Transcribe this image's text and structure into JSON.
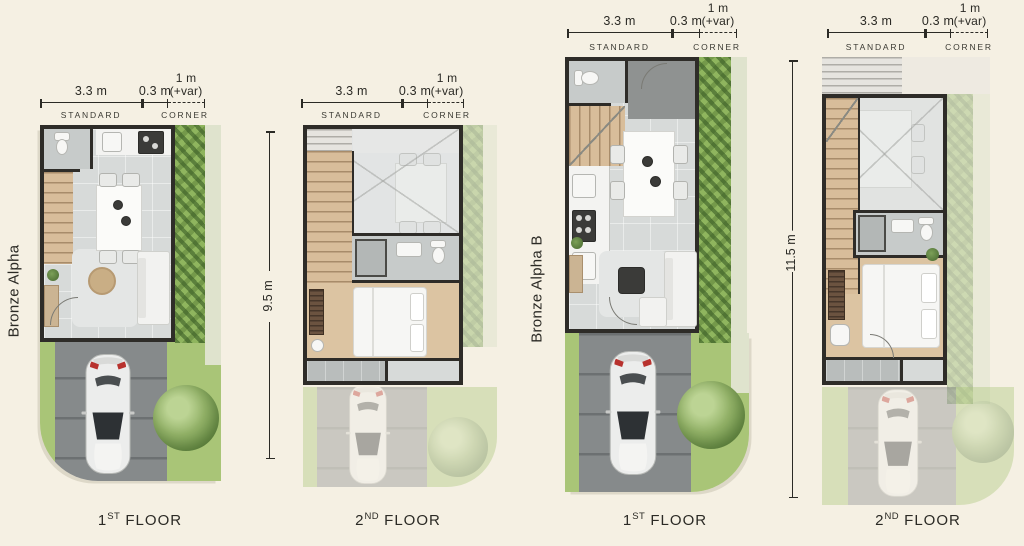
{
  "palette": {
    "bg": "#f5f0e3",
    "ink": "#2b2a25",
    "wall": "#2e2c28",
    "floor": "#d7dad9",
    "floorDark": "#c7cbca",
    "tile": "#8f9291",
    "wood": "#d8bd9a",
    "woodFloor": "#dcc4a2",
    "grass": "#a9c577",
    "hedge": "#8fb55e",
    "path": "#dfe3cd",
    "drive": "#868a8b",
    "carGlass": "#2d3134",
    "tailLight": "#b8322e"
  },
  "plans": [
    {
      "name": "Bronze Alpha",
      "floor": {
        "num": "1",
        "ord": "ST",
        "word": "FLOOR"
      },
      "dims": {
        "standard_value": "3.3 m",
        "wall_value": "0.3 m",
        "corner_value_1": "1 m",
        "corner_value_2": "(+var)",
        "standard_label": "STANDARD",
        "corner_label": "CORNER"
      }
    },
    {
      "floor": {
        "num": "2",
        "ord": "ND",
        "word": "FLOOR"
      },
      "height_dim": "9.5 m",
      "dims": {
        "standard_value": "3.3 m",
        "wall_value": "0.3 m",
        "corner_value_1": "1 m",
        "corner_value_2": "(+var)",
        "standard_label": "STANDARD",
        "corner_label": "CORNER"
      }
    },
    {
      "name": "Bronze Alpha B",
      "floor": {
        "num": "1",
        "ord": "ST",
        "word": "FLOOR"
      },
      "dims": {
        "standard_value": "3.3 m",
        "wall_value": "0.3 m",
        "corner_value_1": "1 m",
        "corner_value_2": "(+var)",
        "standard_label": "STANDARD",
        "corner_label": "CORNER"
      }
    },
    {
      "floor": {
        "num": "2",
        "ord": "ND",
        "word": "FLOOR"
      },
      "height_dim": "11.5 m",
      "dims": {
        "standard_value": "3.3 m",
        "wall_value": "0.3 m",
        "corner_value_1": "1 m",
        "corner_value_2": "(+var)",
        "standard_label": "STANDARD",
        "corner_label": "CORNER"
      }
    }
  ]
}
